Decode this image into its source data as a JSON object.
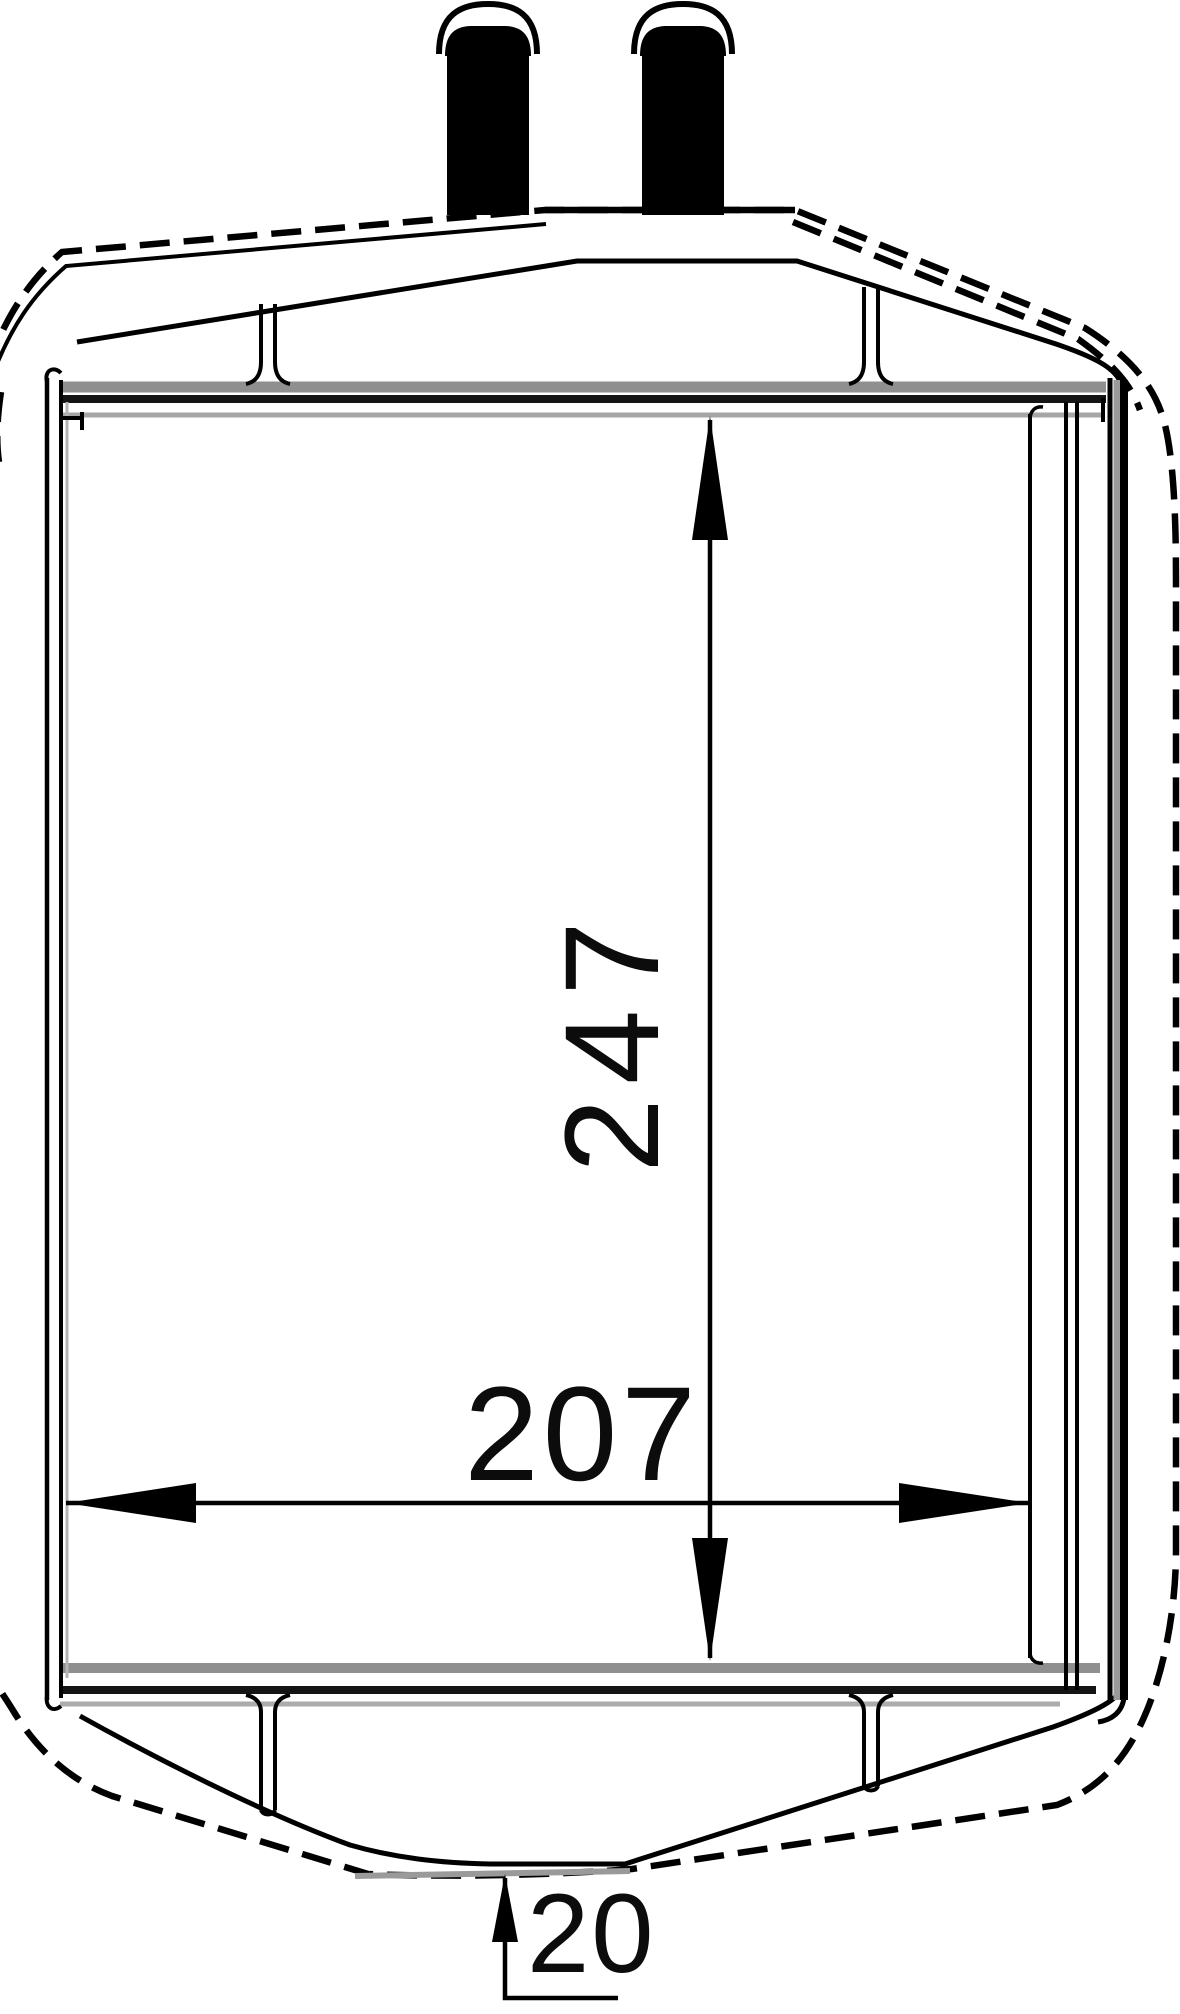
{
  "drawing": {
    "background_color": "#ffffff",
    "line_color": "#000000",
    "gray_line_color": "#8f8f8f",
    "view": "front",
    "subject": "heater-core-technical-drawing",
    "pipes": {
      "count": 2
    },
    "dimensions": {
      "core_height": {
        "value": "247",
        "orientation": "vertical"
      },
      "core_width": {
        "value": "207",
        "orientation": "horizontal"
      },
      "bottom_depth": {
        "value": "20",
        "orientation": "vertical-leader"
      }
    }
  }
}
